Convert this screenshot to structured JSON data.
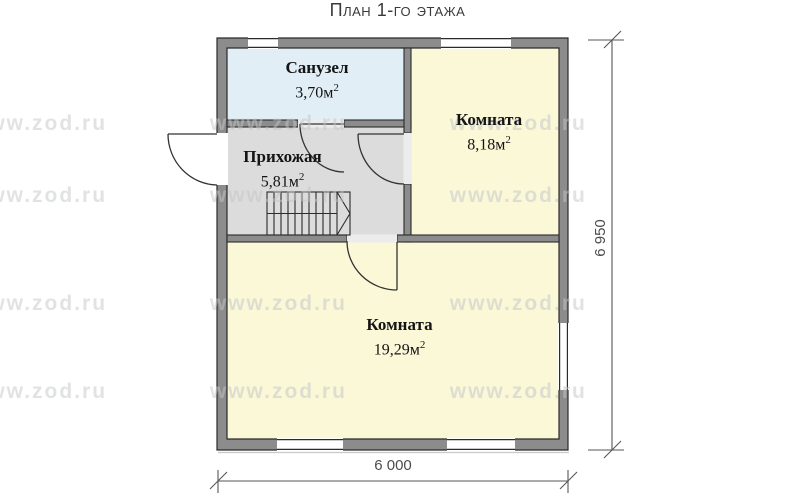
{
  "title": "План 1-го этажа",
  "rooms": [
    {
      "name": "Санузел",
      "area": "3,70м",
      "area_sup": "2"
    },
    {
      "name": "Комната",
      "area": "8,18м",
      "area_sup": "2"
    },
    {
      "name": "Прихожая",
      "area": "5,81м",
      "area_sup": "2"
    },
    {
      "name": "Комната",
      "area": "19,29м",
      "area_sup": "2"
    }
  ],
  "dimensions": {
    "bottom_width": "6 000",
    "right_height": "6 950"
  },
  "watermark": {
    "row": "www.zod.ru www.zod.ru www.zod.ru"
  },
  "colors": {
    "wall_fill": "#8c8c8c",
    "wall_line": "#2b2b2b",
    "bathroom_fill": "#e2eef6",
    "hallway_fill": "#dcdcdc",
    "room_fill": "#fbf8d8",
    "door_line": "#333333",
    "dimension_line": "#555555"
  }
}
